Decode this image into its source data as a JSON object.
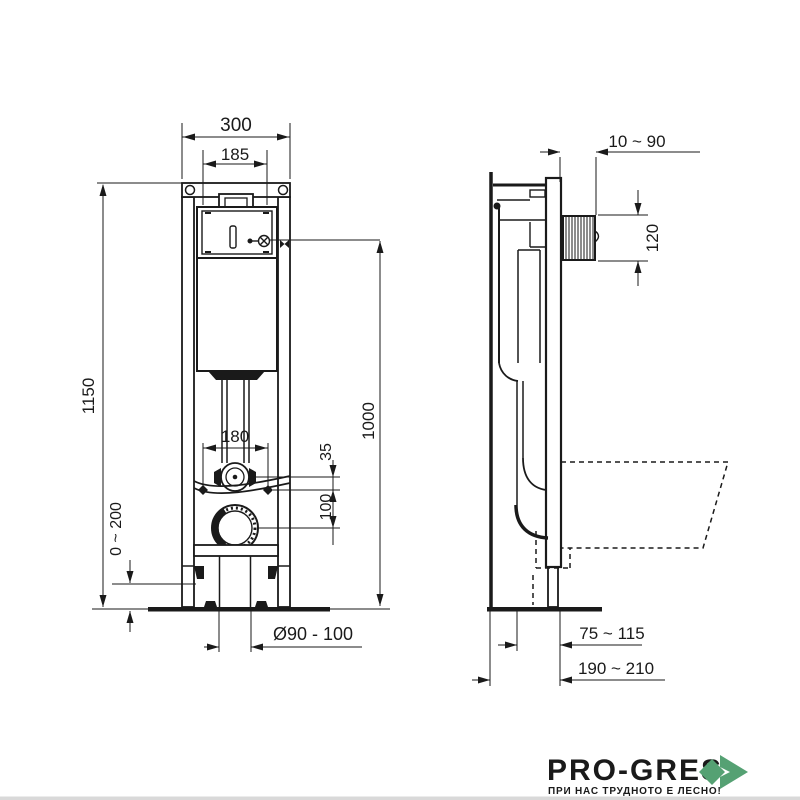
{
  "drawing": {
    "type_label": "concealed WC frame installation drawing",
    "front_view": {
      "dims": {
        "overall_width": "300",
        "cistern_width": "185",
        "overall_height": "1150",
        "fixing_spacing": "180",
        "supply_offset": "35",
        "drain_offset": "100",
        "foot_adjustment": "0 ~ 200",
        "drain_diameter": "Ø90 - 100",
        "flush_height": "1000"
      }
    },
    "side_view": {
      "dims": {
        "wall_offset": "10 ~ 90",
        "sleeve_height": "120",
        "drain_depth": "75 ~ 115",
        "frame_depth": "190 ~ 210"
      }
    }
  },
  "logo": {
    "brand": "PRO-GRES",
    "tagline": "ПРИ НАС ТРУДНОТО Е ЛЕСНО!"
  },
  "colors": {
    "line": "#1a1a1a",
    "brand_text": "#3e4347",
    "brand_green": "#55a173",
    "footer_strip": "#d9d9d9"
  }
}
